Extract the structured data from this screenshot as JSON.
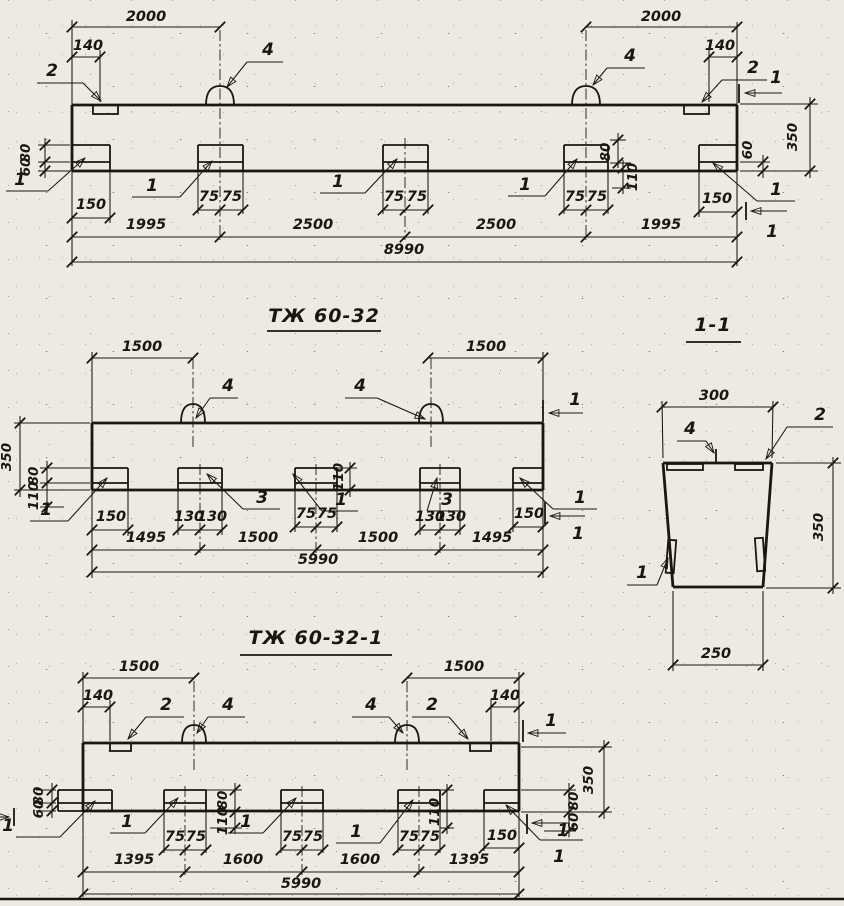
{
  "top_view": {
    "span_left": "2000",
    "span_right": "2000",
    "offset_left": "140",
    "offset_right": "140",
    "left_upper": "80",
    "left_lower": "60",
    "depth": "350",
    "right_lower": "60",
    "end_left": "150",
    "end_right": "150",
    "half": "75",
    "b4_upper": "80",
    "b4_lower": "110",
    "seg1": "1995",
    "seg2": "2500",
    "seg3": "2500",
    "seg4": "1995",
    "overall": "8990",
    "mk_plate": "2",
    "mk_loop": "4",
    "mk_embed": "1",
    "mk_section": "1"
  },
  "mid_view": {
    "title": "ТЖ 60-32",
    "span_left": "1500",
    "span_right": "1500",
    "depth": "350",
    "left_upper": "80",
    "left_lower": "110",
    "b3_dim": "110",
    "end_left": "150",
    "end_right": "150",
    "half_outer": "130",
    "half_center": "75",
    "seg1": "1495",
    "seg2": "1500",
    "seg3": "1500",
    "seg4": "1495",
    "overall": "5990",
    "mk_loop": "4",
    "mk_embed": "1",
    "mk_anchor": "3",
    "mk_section": "1"
  },
  "section_view": {
    "title": "1-1",
    "width_top": "300",
    "depth": "350",
    "width_bottom": "250",
    "mk_loop": "4",
    "mk_plate": "2",
    "mk_embed": "1"
  },
  "bottom_view": {
    "title": "ТЖ 60-32-1",
    "span_left": "1500",
    "span_right": "1500",
    "offset_left": "140",
    "offset_right": "140",
    "left_upper": "80",
    "left_lower": "60",
    "depth": "350",
    "right_upper": "80",
    "right_lower": "60",
    "b2_upper": "80",
    "b2_lower": "110",
    "b4_dim": "110",
    "half": "75",
    "end_right": "150",
    "seg1": "1395",
    "seg2": "1600",
    "seg3": "1600",
    "seg4": "1395",
    "overall": "5990",
    "mk_plate": "2",
    "mk_loop": "4",
    "mk_embed": "1",
    "mk_section": "1"
  }
}
